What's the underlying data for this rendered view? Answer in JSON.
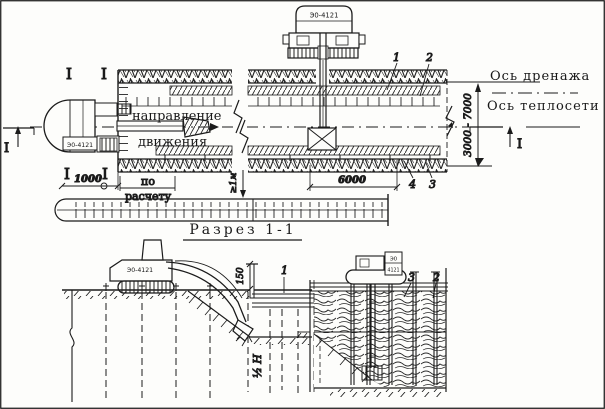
{
  "frame": {
    "paper": "#fdfdfb",
    "ink": "#1b1b1b"
  },
  "plan": {
    "excavator_left_label": "Э0-4121",
    "excavator_top_label": "Э0-4121",
    "direction_word1": "направление",
    "direction_word2": "движения",
    "axis_drain_label": "Ось дренажа",
    "axis_heat_label": "Ось теплосети",
    "section_mark": "I",
    "dim_offset": "1000",
    "dim_calc_word1": "по",
    "dim_calc_word2": "расчету",
    "dim_span": "6000",
    "dim_width_range": "3000 - 7000",
    "dim_min_distance": "≥1м",
    "callout_1": "1",
    "callout_2": "2",
    "callout_3": "3",
    "callout_4": "4"
  },
  "section_view": {
    "title": "Разрез 1-1",
    "excavator_label": "Э0-4121",
    "machine_label_line1": "Э0",
    "machine_label_line2": "4121",
    "dim_board_top": "150",
    "dim_half_depth": "½ Н",
    "callout_1": "1",
    "callout_2": "2",
    "callout_3": "3"
  }
}
